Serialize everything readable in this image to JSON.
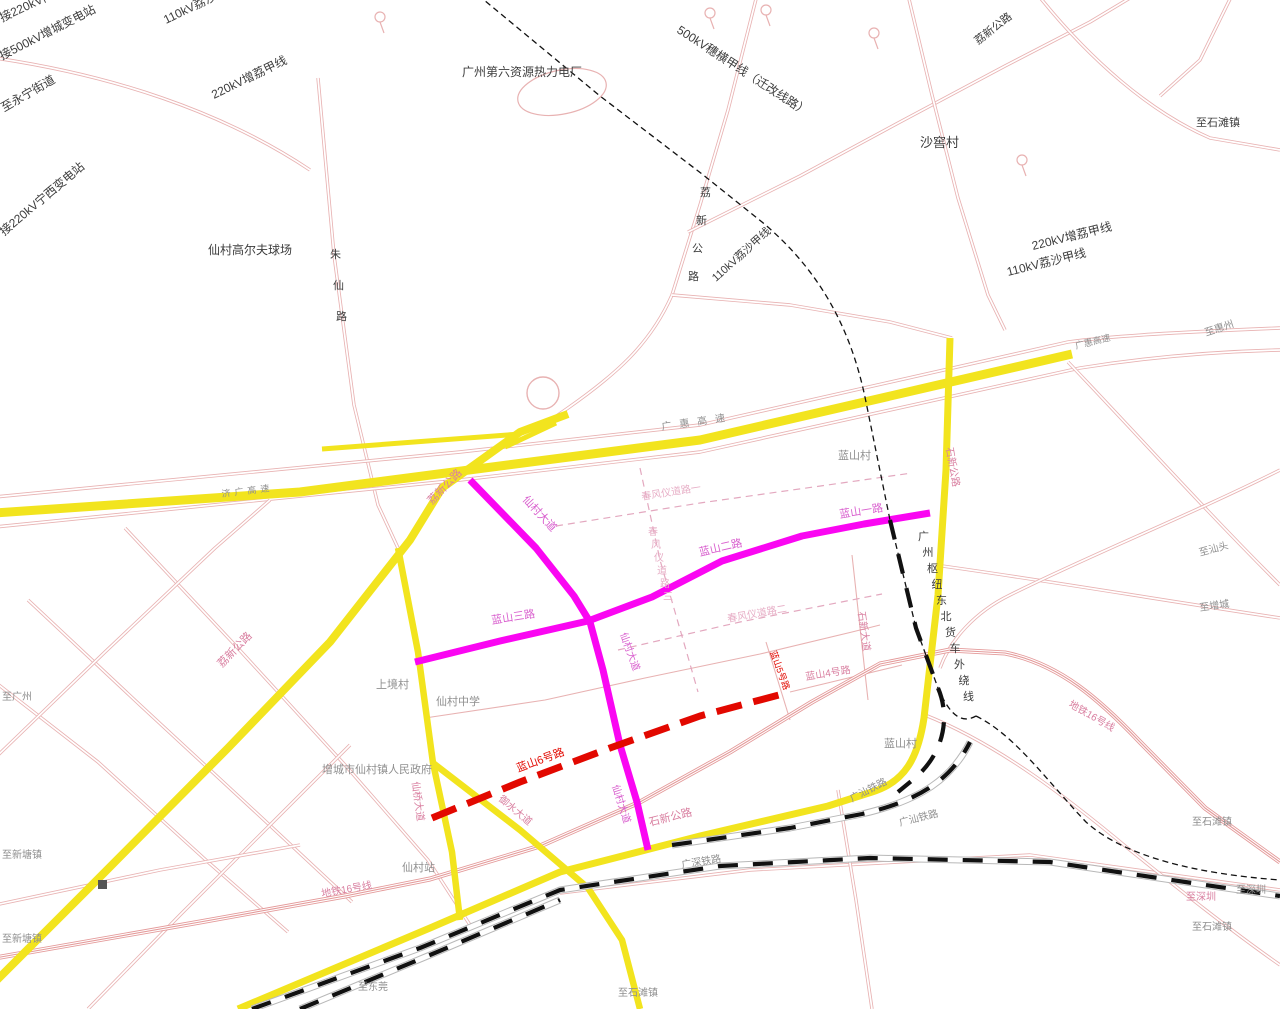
{
  "map": {
    "title": "仙村镇规划路网图",
    "background": "#ffffff"
  },
  "palette": {
    "road_pink": "#e8b2b2",
    "plan_pink": "#e3a8bf",
    "yellow": "#f2e41e",
    "magenta": "#fa06f2",
    "red": "#e20800",
    "metro": "#e49a9a",
    "rail_dark": "#111111",
    "rail_bed": "#b8b8b8",
    "label_dark": "#3c3c3c",
    "label_gray": "#8f8f8f",
    "label_pinkred": "#d97fa0",
    "label_magenta": "#d95fce",
    "label_red": "#e20800",
    "label_lightpink": "#e7aec6"
  },
  "labels": [
    {
      "t": "接220kV门",
      "x": 2,
      "y": 22,
      "r": -25,
      "c": "dark",
      "s": 12
    },
    {
      "t": "接500kV增城变电站",
      "x": 2,
      "y": 60,
      "r": -27,
      "c": "dark",
      "s": 12
    },
    {
      "t": "至永宁街道",
      "x": 4,
      "y": 112,
      "r": -30,
      "c": "dark",
      "s": 12
    },
    {
      "t": "接220kV宁西变电站",
      "x": 4,
      "y": 236,
      "r": -40,
      "c": "dark",
      "s": 12
    },
    {
      "t": "110kV荔沙甲线",
      "x": 166,
      "y": 24,
      "r": -26,
      "c": "dark",
      "s": 12
    },
    {
      "t": "220kV增荔甲线",
      "x": 214,
      "y": 99,
      "r": -26,
      "c": "dark",
      "s": 12
    },
    {
      "t": "仙村高尔夫球场",
      "x": 208,
      "y": 254,
      "r": 0,
      "c": "dark",
      "s": 12
    },
    {
      "t": "朱仙路",
      "x": 330,
      "y": 258,
      "v": true,
      "sx": 3,
      "sy": 31,
      "c": "dark",
      "s": 11
    },
    {
      "t": "广州第六资源热力电厂",
      "x": 462,
      "y": 76,
      "r": 0,
      "c": "dark",
      "s": 12
    },
    {
      "t": "500kV穗横甲线（迁改线路）",
      "x": 676,
      "y": 32,
      "r": 33,
      "c": "dark",
      "s": 12
    },
    {
      "t": "荔新公路",
      "x": 978,
      "y": 45,
      "r": -38,
      "c": "dark",
      "s": 11
    },
    {
      "t": "沙窖村",
      "x": 920,
      "y": 147,
      "r": 0,
      "c": "dark",
      "s": 13
    },
    {
      "t": "至石滩镇",
      "x": 1196,
      "y": 126,
      "r": 0,
      "c": "dark",
      "s": 11
    },
    {
      "t": "220kV增荔甲线",
      "x": 1033,
      "y": 250,
      "r": -14,
      "c": "dark",
      "s": 12
    },
    {
      "t": "110kV荔沙甲线",
      "x": 1008,
      "y": 276,
      "r": -14,
      "c": "dark",
      "s": 12
    },
    {
      "t": "荔新公路",
      "x": 700,
      "y": 196,
      "v": true,
      "sx": -4,
      "sy": 28,
      "c": "dark",
      "s": 11
    },
    {
      "t": "110kV荔沙甲线",
      "x": 716,
      "y": 282,
      "r": -42,
      "c": "dark",
      "s": 11
    },
    {
      "t": "广惠高速",
      "x": 662,
      "y": 430,
      "r": -8,
      "c": "gray",
      "s": 10,
      "ls": 8
    },
    {
      "t": "至惠州",
      "x": 1206,
      "y": 336,
      "r": -18,
      "c": "gray",
      "s": 10
    },
    {
      "t": "广惠高速",
      "x": 1076,
      "y": 349,
      "r": -14,
      "c": "gray",
      "s": 9
    },
    {
      "t": "济广高速",
      "x": 222,
      "y": 497,
      "r": -7,
      "c": "gray",
      "s": 9,
      "ls": 4
    },
    {
      "t": "荔新公路",
      "x": 432,
      "y": 505,
      "r": -46,
      "c": "pinkred",
      "s": 11
    },
    {
      "t": "荔新公路",
      "x": 222,
      "y": 668,
      "r": -46,
      "c": "pinkred",
      "s": 11
    },
    {
      "t": "蓝山村",
      "x": 838,
      "y": 459,
      "r": 0,
      "c": "gray",
      "s": 11
    },
    {
      "t": "春风仪道路一",
      "x": 642,
      "y": 500,
      "r": -9,
      "c": "lightpink",
      "s": 10
    },
    {
      "t": "春风仪道路三",
      "x": 648,
      "y": 535,
      "v": true,
      "sx": 3,
      "sy": 13,
      "c": "lightpink",
      "s": 10
    },
    {
      "t": "春风仪道路二",
      "x": 728,
      "y": 622,
      "r": -10,
      "c": "lightpink",
      "s": 10
    },
    {
      "t": "蓝山一路",
      "x": 840,
      "y": 518,
      "r": -9,
      "c": "magenta",
      "s": 11
    },
    {
      "t": "蓝山二路",
      "x": 700,
      "y": 556,
      "r": -13,
      "c": "magenta",
      "s": 11
    },
    {
      "t": "蓝山三路",
      "x": 492,
      "y": 624,
      "r": -9,
      "c": "magenta",
      "s": 11
    },
    {
      "t": "仙村大道",
      "x": 522,
      "y": 500,
      "r": 47,
      "c": "magenta",
      "s": 11
    },
    {
      "t": "仙村大道",
      "x": 620,
      "y": 634,
      "r": 70,
      "c": "magenta",
      "s": 10
    },
    {
      "t": "仙村大道",
      "x": 612,
      "y": 786,
      "r": 72,
      "c": "magenta",
      "s": 10
    },
    {
      "t": "石新公路",
      "x": 946,
      "y": 448,
      "r": 80,
      "c": "pinkred",
      "s": 10
    },
    {
      "t": "石新大道",
      "x": 858,
      "y": 612,
      "r": 82,
      "c": "pinkred",
      "s": 10
    },
    {
      "t": "蓝山4号路",
      "x": 806,
      "y": 680,
      "r": -9,
      "c": "pinkred",
      "s": 10
    },
    {
      "t": "蓝山5号路",
      "x": 770,
      "y": 652,
      "r": 70,
      "c": "red",
      "s": 9
    },
    {
      "t": "蓝山6号路",
      "x": 518,
      "y": 772,
      "r": -20,
      "c": "red",
      "s": 11
    },
    {
      "t": "上境村",
      "x": 376,
      "y": 688,
      "r": 0,
      "c": "gray",
      "s": 11
    },
    {
      "t": "仙村中学",
      "x": 436,
      "y": 705,
      "r": 0,
      "c": "gray",
      "s": 11
    },
    {
      "t": "增城市仙村镇人民政府",
      "x": 322,
      "y": 773,
      "r": 0,
      "c": "gray",
      "s": 11
    },
    {
      "t": "仙桥大道",
      "x": 412,
      "y": 782,
      "r": 82,
      "c": "pinkred",
      "s": 10
    },
    {
      "t": "御水大道",
      "x": 498,
      "y": 800,
      "r": 40,
      "c": "pinkred",
      "s": 10
    },
    {
      "t": "仙村站",
      "x": 402,
      "y": 871,
      "r": 0,
      "c": "gray",
      "s": 11
    },
    {
      "t": "地铁16号线",
      "x": 322,
      "y": 897,
      "r": -10,
      "c": "pinkred",
      "s": 10
    },
    {
      "t": "石新公路",
      "x": 650,
      "y": 826,
      "r": -14,
      "c": "pinkred",
      "s": 11
    },
    {
      "t": "广汕铁路",
      "x": 852,
      "y": 802,
      "r": -27,
      "c": "gray",
      "s": 10
    },
    {
      "t": "广汕铁路",
      "x": 900,
      "y": 826,
      "r": -14,
      "c": "gray",
      "s": 10
    },
    {
      "t": "广深铁路",
      "x": 682,
      "y": 868,
      "r": -9,
      "c": "gray",
      "s": 10
    },
    {
      "t": "广州枢纽东北货车外绕线",
      "x": 918,
      "y": 540,
      "v": true,
      "sx": 4.5,
      "sy": 16,
      "c": "dark",
      "s": 11
    },
    {
      "t": "蓝山村",
      "x": 884,
      "y": 747,
      "r": 0,
      "c": "gray",
      "s": 11
    },
    {
      "t": "地铁16号线",
      "x": 1068,
      "y": 706,
      "r": 30,
      "c": "pinkred",
      "s": 10
    },
    {
      "t": "至汕头",
      "x": 1200,
      "y": 556,
      "r": -15,
      "c": "gray",
      "s": 10
    },
    {
      "t": "至增城",
      "x": 1200,
      "y": 611,
      "r": -8,
      "c": "gray",
      "s": 10
    },
    {
      "t": "至石滩镇",
      "x": 1192,
      "y": 825,
      "r": 0,
      "c": "gray",
      "s": 10
    },
    {
      "t": "至深圳",
      "x": 1186,
      "y": 900,
      "r": 0,
      "c": "pinkred",
      "s": 10
    },
    {
      "t": "至深圳",
      "x": 1236,
      "y": 893,
      "r": 0,
      "c": "gray",
      "s": 10
    },
    {
      "t": "至石滩镇",
      "x": 1192,
      "y": 930,
      "r": 0,
      "c": "gray",
      "s": 10
    },
    {
      "t": "至广州",
      "x": 2,
      "y": 700,
      "r": 0,
      "c": "gray",
      "s": 10
    },
    {
      "t": "至新塘镇",
      "x": 2,
      "y": 858,
      "r": 0,
      "c": "gray",
      "s": 10
    },
    {
      "t": "至新塘镇",
      "x": 2,
      "y": 942,
      "r": 0,
      "c": "gray",
      "s": 10
    },
    {
      "t": "至东莞",
      "x": 358,
      "y": 990,
      "r": 0,
      "c": "gray",
      "s": 10
    },
    {
      "t": "至石滩镇",
      "x": 618,
      "y": 996,
      "r": 0,
      "c": "gray",
      "s": 10
    }
  ]
}
